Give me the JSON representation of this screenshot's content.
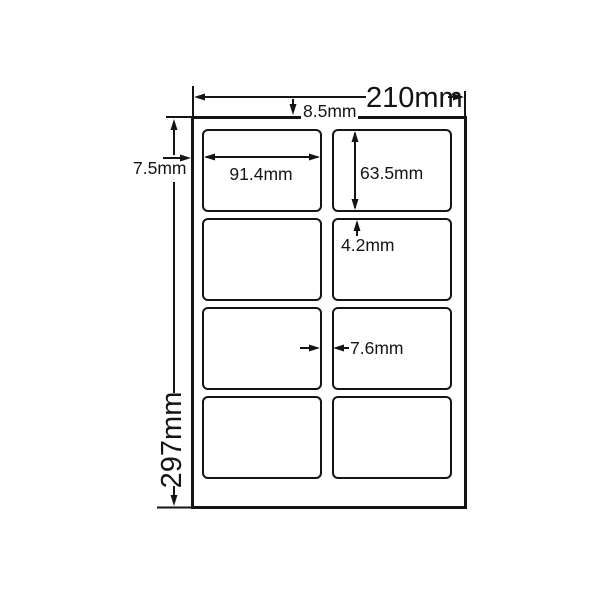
{
  "diagram": {
    "type": "label-sheet-dimension-diagram",
    "sheet": {
      "width": "210mm",
      "height": "297mm",
      "top_margin": "8.5mm",
      "side_margin": "7.5mm"
    },
    "label": {
      "width": "91.4mm",
      "height": "63.5mm"
    },
    "gaps": {
      "row_gap": "4.2mm",
      "column_gap": "7.6mm"
    },
    "grid": {
      "rows": 4,
      "columns": 2,
      "label_count": 8
    },
    "colors": {
      "line": "#141414",
      "background": "#ffffff"
    }
  }
}
